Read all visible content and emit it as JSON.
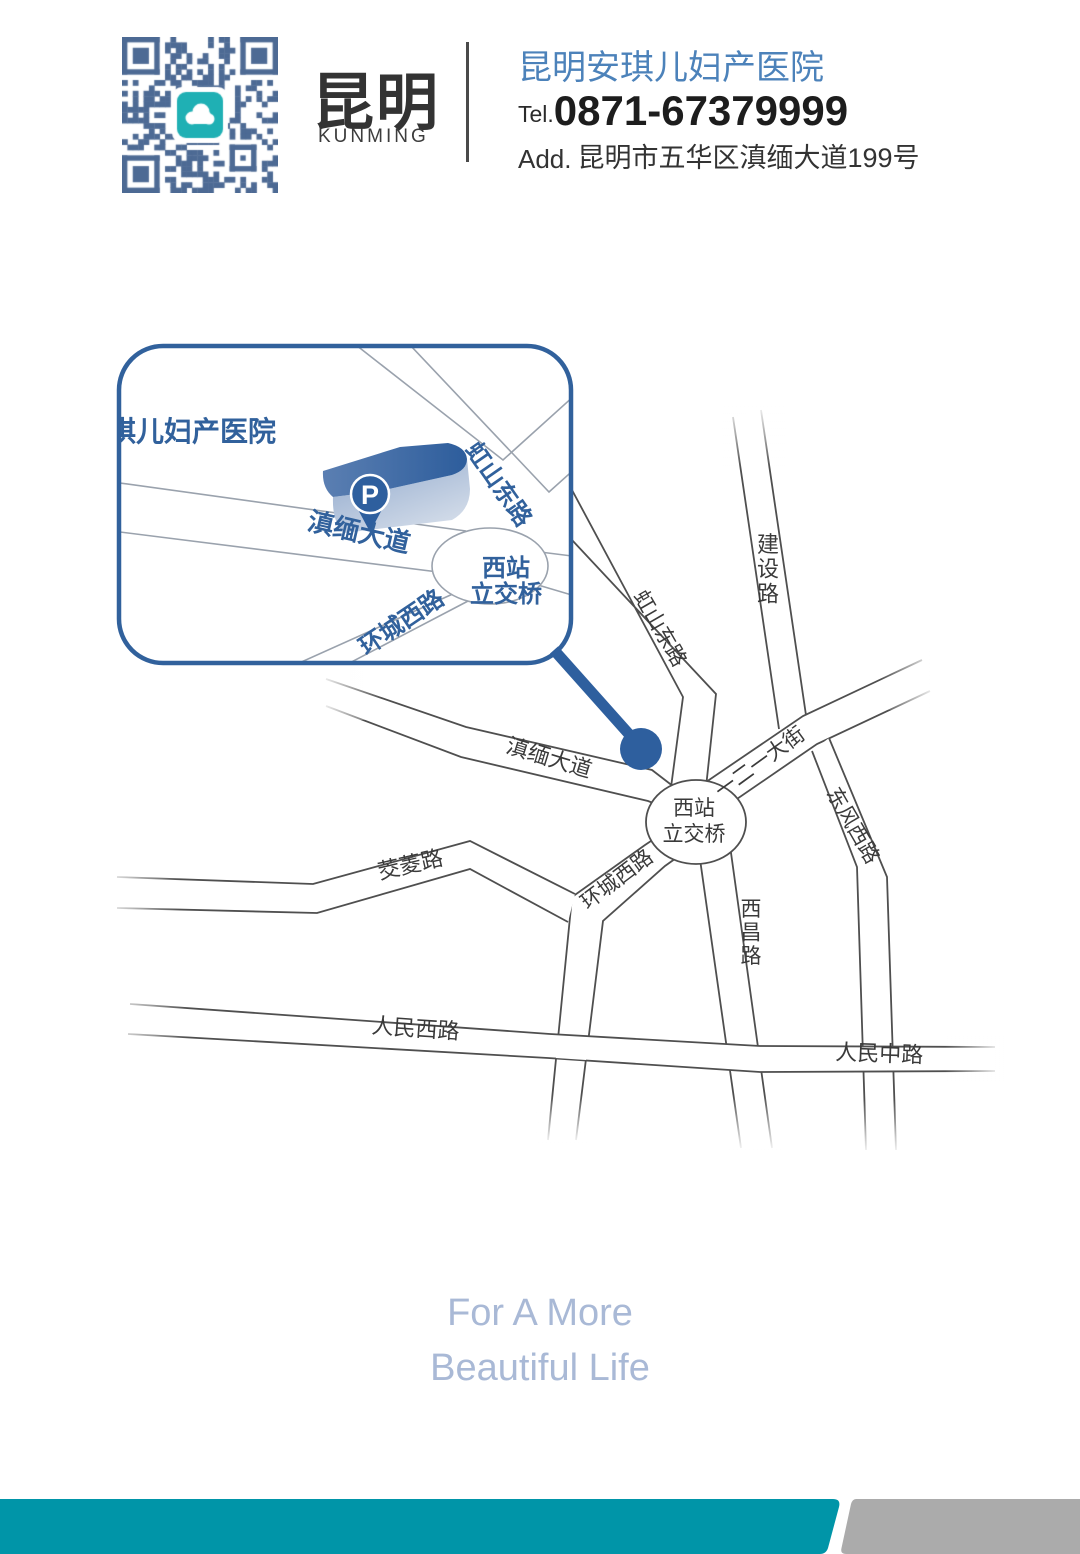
{
  "header": {
    "brand_cn": "昆明",
    "brand_en": "KUNMING",
    "hospital_name": "昆明安琪儿妇产医院",
    "tel_label": "Tel.",
    "tel_number": "0871-67379999",
    "add_label": "Add.",
    "address": "昆明市五华区滇缅大道199号"
  },
  "inset": {
    "title": "昆明安琪儿妇产医院",
    "parking_label": "P",
    "roads": {
      "dianmian_avenue": "滇缅大道",
      "hongshan_east_road": "虹山东路",
      "interchange_line1": "西站",
      "interchange_line2": "立交桥",
      "huancheng_west_road": "环城西路"
    }
  },
  "map": {
    "roads": {
      "jianshe_road": "建设路",
      "hongshan_east_road": "虹山东路",
      "dianmian_avenue": "滇缅大道",
      "yiereyi_street": "一二一大街",
      "dongfeng_west_road": "东风西路",
      "interchange_line1": "西站",
      "interchange_line2": "立交桥",
      "huancheng_west_road": "环城西路",
      "xichang_road": "西昌路",
      "jiaoling_road": "茭菱路",
      "renmin_west_road": "人民西路",
      "renmin_middle_road": "人民中路"
    }
  },
  "footer": {
    "slogan_line1": "For A More",
    "slogan_line2": "Beautiful Life"
  },
  "colors": {
    "accent_blue": "#2e5f9e",
    "inset_border_blue": "#31619c",
    "hospital_name_blue": "#4c82ba",
    "road_outline": "#4f4f4f",
    "inset_road_line": "#9aa2ad",
    "teal_bar": "#0095a8",
    "gray_bar": "#ababab",
    "slogan_blue": "#a9b9d6",
    "qr_blue": "#4d6a94",
    "qr_center_teal": "#1fb0b4",
    "text_dark": "#333333"
  }
}
